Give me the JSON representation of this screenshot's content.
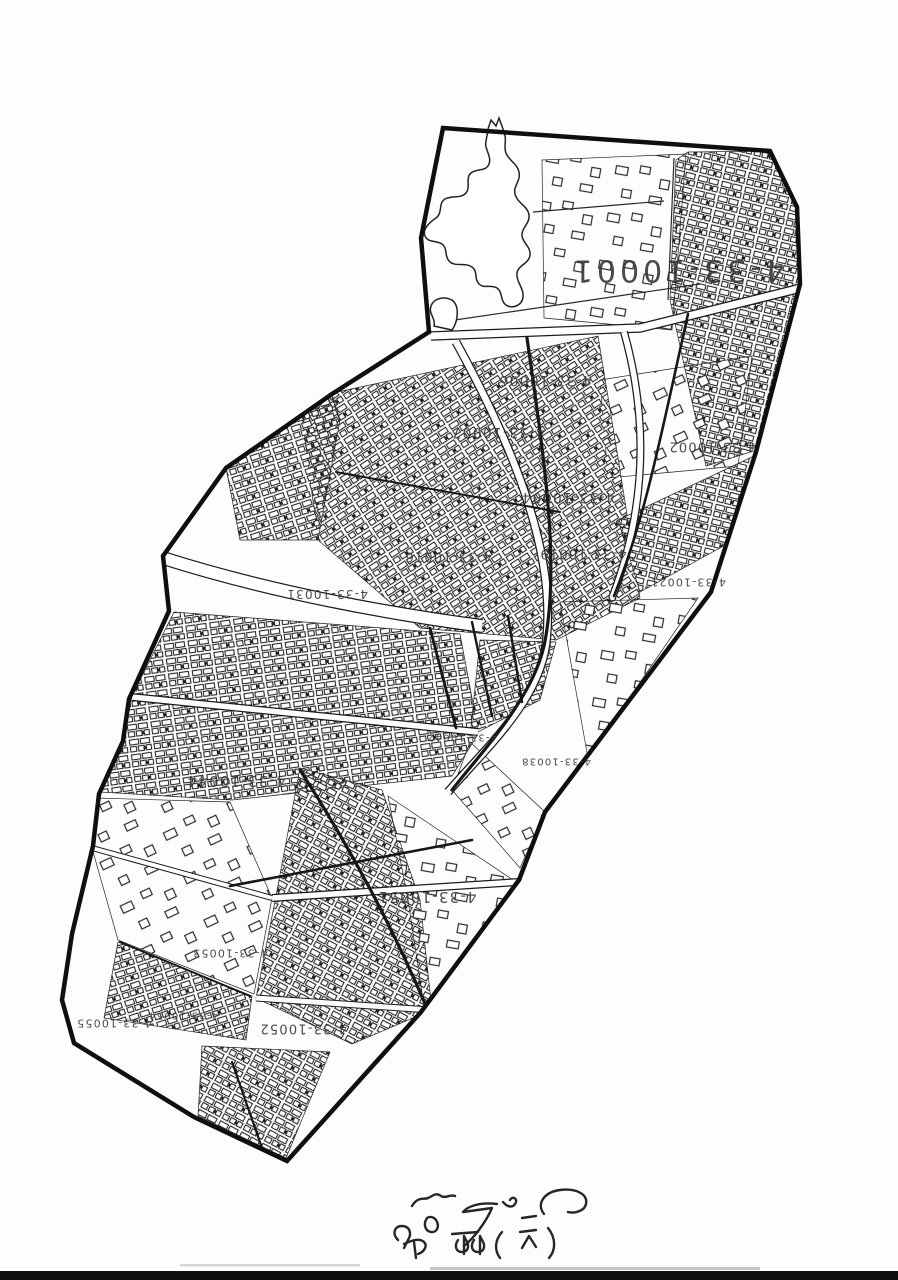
{
  "document": {
    "kind": "scanned cadastral block map sheet",
    "orientation": "map content printed rotated 180 degrees on page"
  },
  "colors": {
    "paper": "#fdfdfc",
    "ink": "#1c1c1c",
    "label_ink": "#3b3b3b",
    "scan_edge_band": "#0f0f0f"
  },
  "map": {
    "sheet_series": "4-33",
    "zone_labels": [
      {
        "text": "4-33-10001",
        "x": 677,
        "y": 270,
        "size": 30
      },
      {
        "text": "4-33-10006",
        "x": 545,
        "y": 380,
        "size": 14
      },
      {
        "text": "4-33-10007",
        "x": 498,
        "y": 432,
        "size": 14
      },
      {
        "text": "4-33-10002",
        "x": 712,
        "y": 446,
        "size": 13
      },
      {
        "text": "4-33-10004",
        "x": 568,
        "y": 497,
        "size": 14
      },
      {
        "text": "4-33-10016",
        "x": 448,
        "y": 556,
        "size": 13
      },
      {
        "text": "4-33-10019",
        "x": 583,
        "y": 553,
        "size": 13
      },
      {
        "text": "4-33-10021",
        "x": 688,
        "y": 582,
        "size": 11
      },
      {
        "text": "4-33-10031",
        "x": 327,
        "y": 594,
        "size": 12
      },
      {
        "text": "4-33-10042",
        "x": 462,
        "y": 737,
        "size": 10
      },
      {
        "text": "4-33-10038",
        "x": 556,
        "y": 761,
        "size": 10
      },
      {
        "text": "4-33-10044",
        "x": 236,
        "y": 781,
        "size": 15
      },
      {
        "text": "4-33-10051",
        "x": 427,
        "y": 897,
        "size": 15
      },
      {
        "text": "4-33-10053",
        "x": 230,
        "y": 953,
        "size": 11
      },
      {
        "text": "4-33-10054",
        "x": 183,
        "y": 1015,
        "size": 10
      },
      {
        "text": "4-33-10052",
        "x": 303,
        "y": 1028,
        "size": 13
      },
      {
        "text": "4-33-10055",
        "x": 114,
        "y": 1023,
        "size": 11
      }
    ],
    "handwritten_note": {
      "present": true,
      "legible": false,
      "location": "bottom-center of page"
    }
  }
}
